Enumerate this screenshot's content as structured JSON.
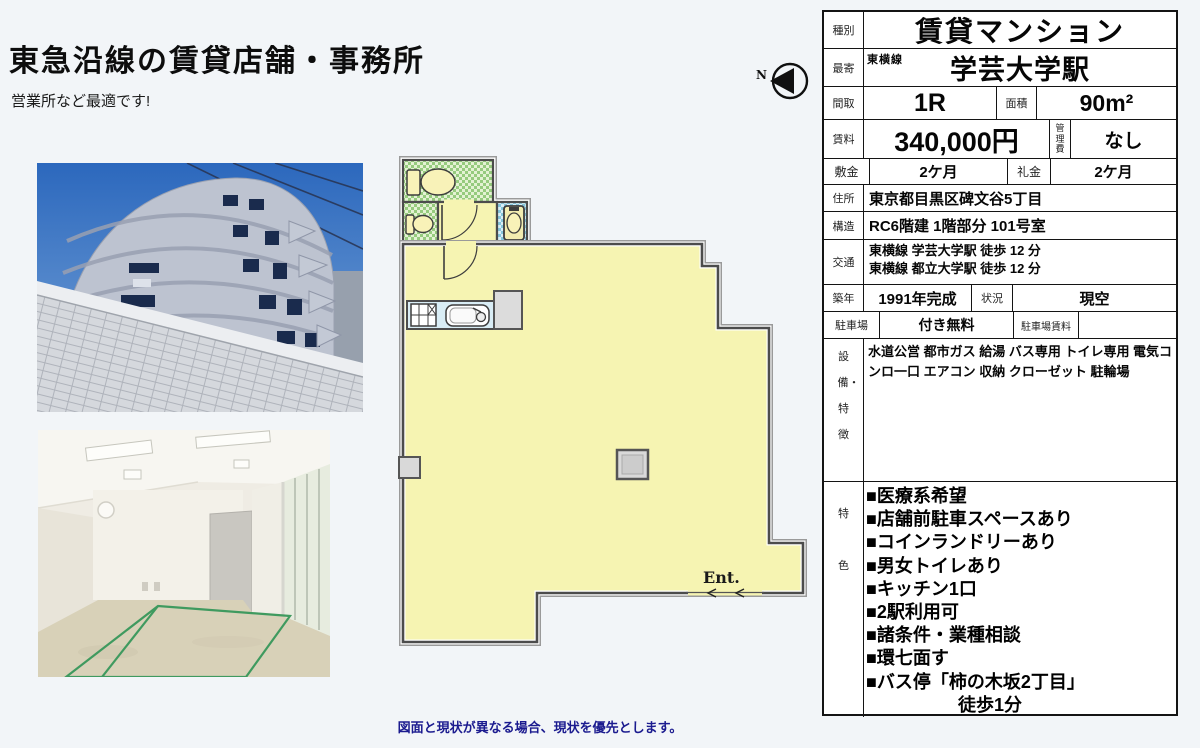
{
  "page": {
    "title": "東急沿線の賃貸店舗・事務所",
    "subtitle": "営業所など最適です!",
    "footer_note": "図面と現状が異なる場合、現状を優先とします。",
    "bg_color": "#f2f5f8",
    "note_color": "#1b1b8f"
  },
  "floorplan": {
    "entrance_label": "Ent.",
    "compass_label": "N",
    "room_color": "#f6f4b2",
    "wet_area_color": "#96cb7e",
    "basin_area_color": "#86c6dc"
  },
  "table": {
    "type": {
      "label": "種別",
      "value": "賃貸マンション"
    },
    "nearest": {
      "label": "最寄",
      "line": "東横線",
      "value": "学芸大学駅"
    },
    "layout": {
      "label": "間取",
      "value": "1R",
      "area_label": "面積",
      "area_value": "90m²"
    },
    "rent": {
      "label": "賃料",
      "value": "340,000円",
      "fee_label": "管理費",
      "fee_value": "なし"
    },
    "deposit": {
      "label": "敷金",
      "value": "2ケ月",
      "key_label": "礼金",
      "key_value": "2ケ月"
    },
    "address": {
      "label": "住所",
      "value": "東京都目黒区碑文谷5丁目"
    },
    "structure": {
      "label": "構造",
      "value": "RC6階建 1階部分 101号室"
    },
    "access": {
      "label": "交通",
      "lines": [
        "東横線 学芸大学駅 徒歩 12 分",
        "東横線 都立大学駅 徒歩 12 分"
      ]
    },
    "built": {
      "label": "築年",
      "value": "1991年完成",
      "status_label": "状況",
      "status_value": "現空"
    },
    "parking": {
      "label": "駐車場",
      "value": "付き無料",
      "fee_label": "駐車場賃料",
      "fee_value": ""
    },
    "equipment": {
      "label": "設備・特徴",
      "value": "水道公営 都市ガス 給湯 バス専用 トイレ専用 電気コンロ一口 エアコン 収納 クローゼット 駐輪場"
    },
    "features": {
      "label": "特色",
      "items": [
        "■医療系希望",
        "■店舗前駐車スペースあり",
        "■コインランドリーあり",
        "■男女トイレあり",
        "■キッチン1口",
        "■2駅利用可",
        "■諸条件・業種相談",
        "■環七面す",
        "■バス停「柿の木坂2丁目」",
        "徒歩1分"
      ]
    }
  }
}
